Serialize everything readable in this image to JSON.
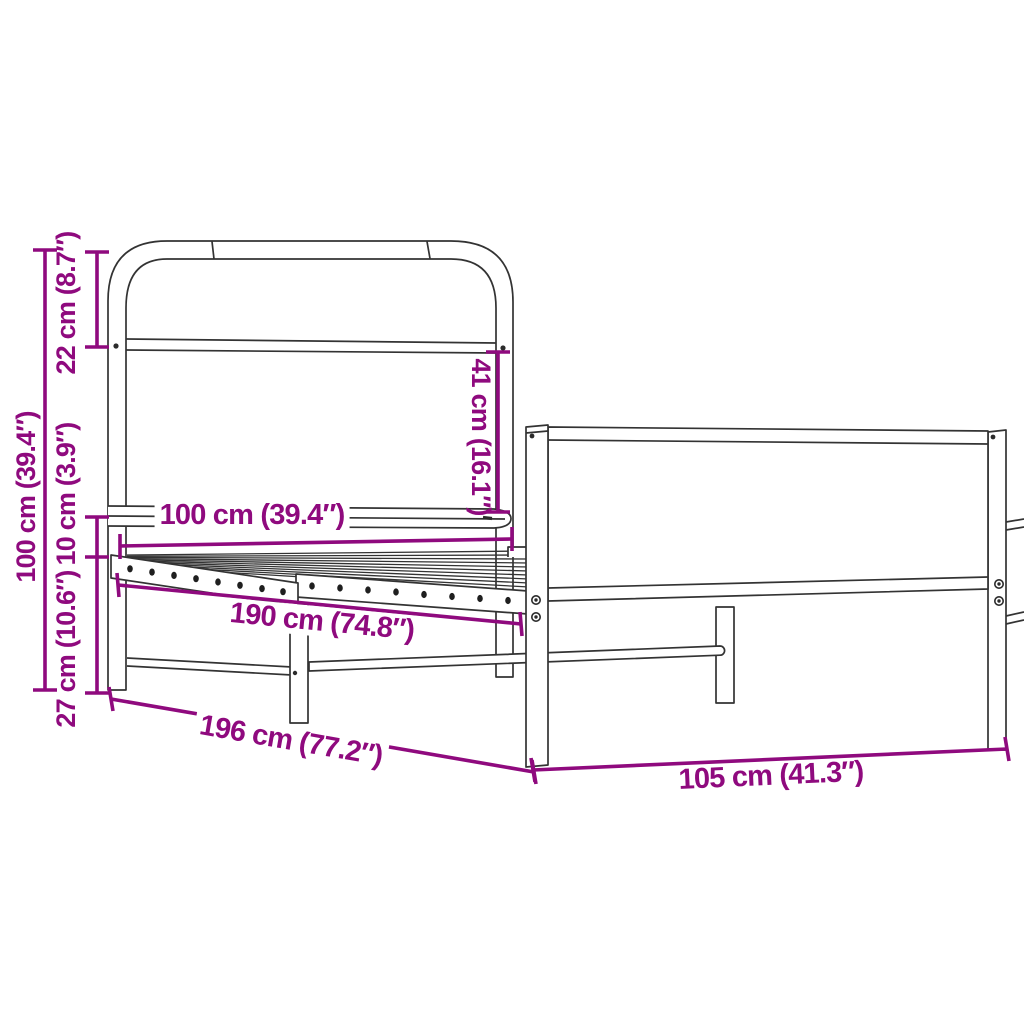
{
  "colors": {
    "accent": "#8F0A7E",
    "line": "#333333",
    "background": "#FFFFFF"
  },
  "diagram": {
    "labels": {
      "total_height": "100 cm (39.4″)",
      "headboard_top": "22 cm (8.7″)",
      "rail_height": "10 cm (3.9″)",
      "clearance": "27 cm (10.6″)",
      "headboard_width": "100 cm (39.4″)",
      "headboard_panel_height": "41 cm (16.1″)",
      "inner_length": "190 cm (74.8″)",
      "outer_length": "196 cm (77.2″)",
      "footboard_width": "105 cm (41.3″)"
    }
  }
}
